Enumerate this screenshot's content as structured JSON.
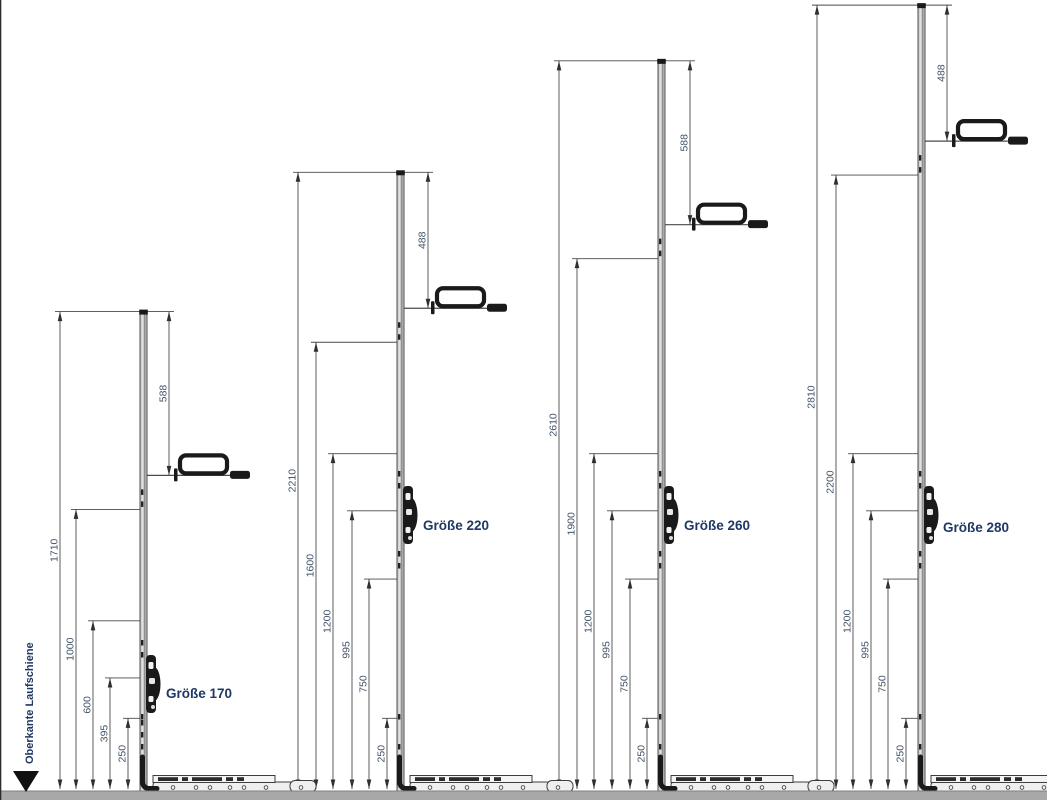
{
  "drawing": {
    "reference_label": "Oberkante Laufschiene",
    "unit": "mm",
    "scale_px_per_mm": 0.2786,
    "baseline_y": 788,
    "colors": {
      "dimension_line": "#4a4a4a",
      "arrow": "#2f2f2f",
      "dimension_text": "#44546a",
      "label_text": "#1f3864",
      "rail_fill": "#c9c9c9",
      "rail_stroke": "#3d3d3d",
      "hardware_dark": "#1a1a1a",
      "floor_bar": "#a8a8a8"
    },
    "groups": [
      {
        "name": "Größe 170",
        "total_height_mm": 1710,
        "handle_from_top_mm": 588,
        "height_dims_mm": [
          1710,
          1000,
          600,
          395,
          250
        ]
      },
      {
        "name": "Größe 220",
        "total_height_mm": 2210,
        "handle_from_top_mm": 488,
        "height_dims_mm": [
          2210,
          1600,
          1200,
          995,
          750,
          250
        ]
      },
      {
        "name": "Größe 260",
        "total_height_mm": 2610,
        "handle_from_top_mm": 588,
        "height_dims_mm": [
          2610,
          1900,
          1200,
          995,
          750,
          250
        ]
      },
      {
        "name": "Größe 280",
        "total_height_mm": 2810,
        "handle_from_top_mm": 488,
        "height_dims_mm": [
          2810,
          2200,
          1200,
          995,
          750,
          250
        ]
      }
    ]
  }
}
